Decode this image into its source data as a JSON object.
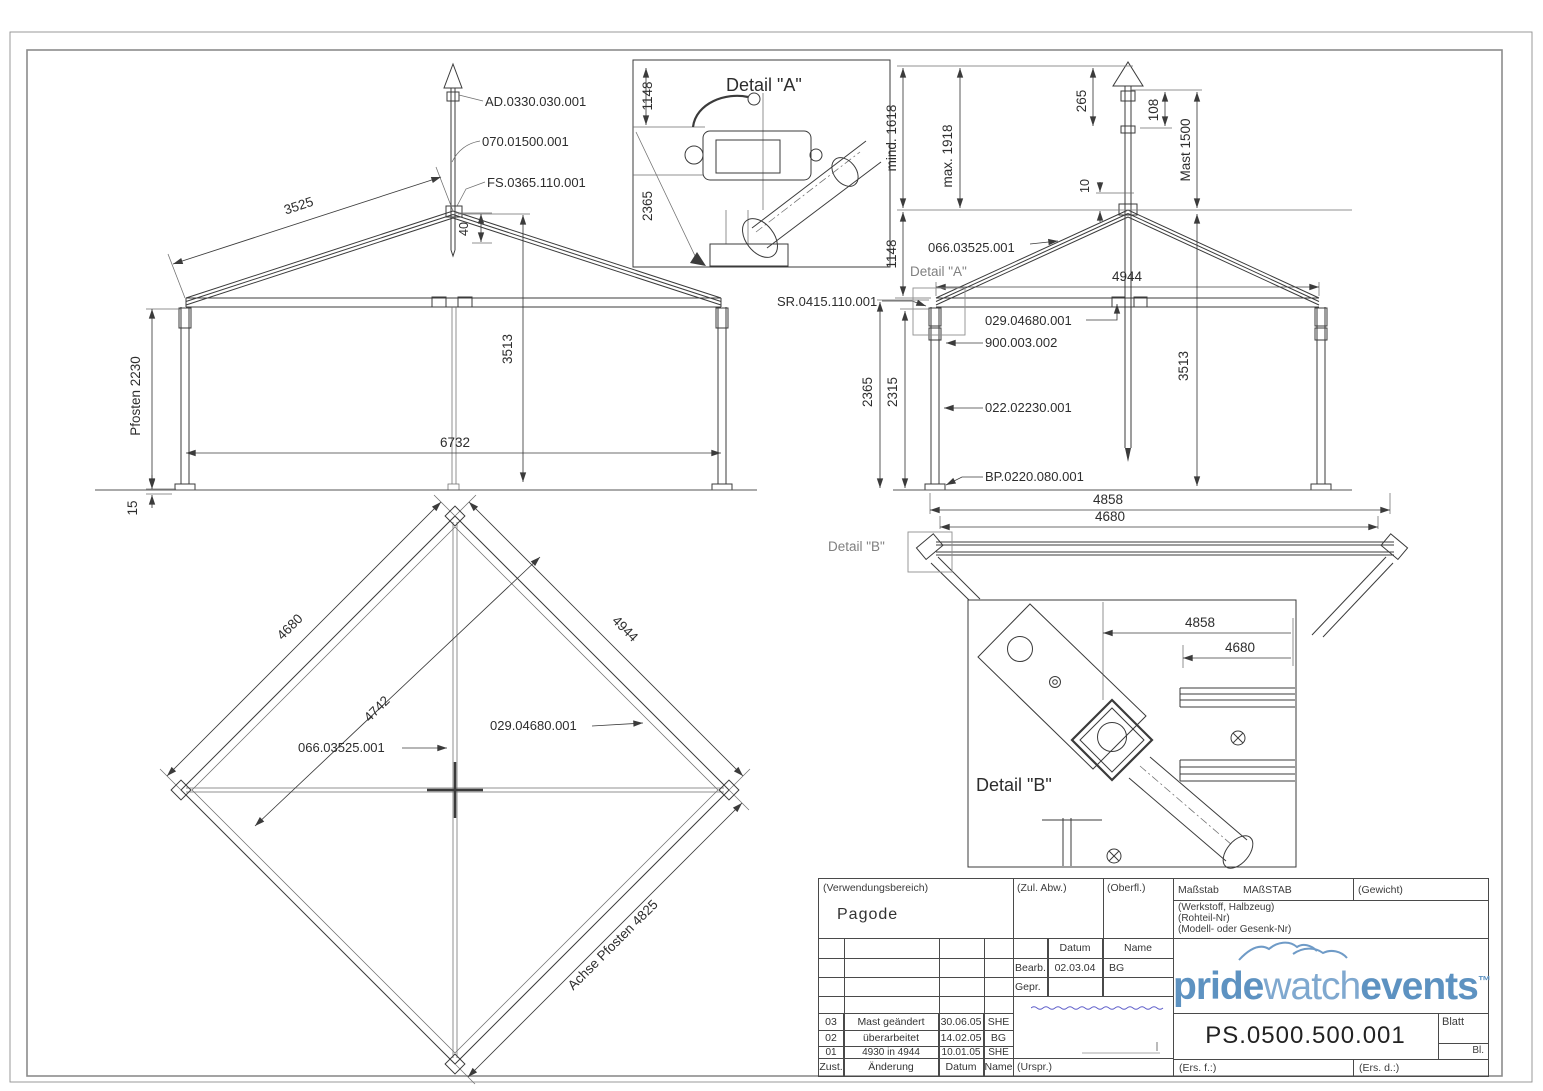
{
  "sheet": {
    "detail_a": {
      "title": "Detail \"A\"",
      "dim_1148": "1148",
      "dim_2365": "2365"
    },
    "front_view": {
      "part_ad": "AD.0330.030.001",
      "part_mast": "070.01500.001",
      "part_fs": "FS.0365.110.001",
      "dim_rafter": "3525",
      "dim_post": "Pfosten 2230",
      "dim_base": "15",
      "dim_height": "3513",
      "dim_gap": "40",
      "dim_width": "6732"
    },
    "side_view": {
      "dim_mind": "mind. 1618",
      "dim_max": "max. 1918",
      "dim_265": "265",
      "dim_108": "108",
      "dim_mast": "Mast 1500",
      "dim_10": "10",
      "dim_1148": "1148",
      "dim_4944": "4944",
      "part_sr": "SR.0415.110.001",
      "part_truss": "066.03525.001",
      "part_beam": "029.04680.001",
      "part_bracket": "900.003.002",
      "part_post": "022.02230.001",
      "part_base": "BP.0220.080.001",
      "callout_a": "Detail \"A\"",
      "callout_b": "Detail \"B\"",
      "dim_2365": "2365",
      "dim_2315": "2315",
      "dim_height": "3513",
      "dim_4858": "4858",
      "dim_4680": "4680"
    },
    "plan_view": {
      "dim_4680": "4680",
      "dim_4944": "4944",
      "dim_4742": "4742",
      "dim_achse": "Achse Pfosten 4825",
      "part_truss": "066.03525.001",
      "part_beam": "029.04680.001"
    },
    "detail_b": {
      "title": "Detail \"B\"",
      "dim_4858": "4858",
      "dim_4680": "4680"
    }
  },
  "title_block": {
    "verwendungsbereich": "(Verwendungsbereich)",
    "product": "Pagode",
    "zul_abw": "(Zul. Abw.)",
    "oberfl": "(Oberfl.)",
    "massstab_label": "Maßstab",
    "massstab_value": "MAßSTAB",
    "gewicht": "(Gewicht)",
    "werkstoff": "(Werkstoff, Halbzeug)",
    "rohteil": "(Rohteil-Nr)",
    "modell": "(Modell- oder Gesenk-Nr)",
    "datum_header": "Datum",
    "name_header": "Name",
    "bearb_label": "Bearb.",
    "bearb_datum": "02.03.04",
    "bearb_name": "BG",
    "gepr_label": "Gepr.",
    "revisions": [
      {
        "zust": "03",
        "aenderung": "Mast geändert",
        "datum": "30.06.05",
        "name": "SHE"
      },
      {
        "zust": "02",
        "aenderung": "überarbeitet",
        "datum": "14.02.05",
        "name": "BG"
      },
      {
        "zust": "01",
        "aenderung": "4930 in 4944",
        "datum": "10.01.05",
        "name": "SHE"
      }
    ],
    "zust_header": "Zust.",
    "aenderung_header": "Änderung",
    "rev_datum_header": "Datum",
    "rev_name_header": "Name",
    "urspr": "(Urspr.)",
    "ers_f": "(Ers. f.:)",
    "ers_d": "(Ers. d.:)",
    "blatt": "Blatt",
    "bl": "Bl.",
    "drawing_number": "PS.0500.500.001",
    "logo": {
      "part1": "pride",
      "part2": "watch",
      "part3": "events",
      "tm": "™",
      "color_bold": "#5d92c1",
      "color_light": "#7fa8cf",
      "signature_color": "#5a5ac8"
    }
  }
}
